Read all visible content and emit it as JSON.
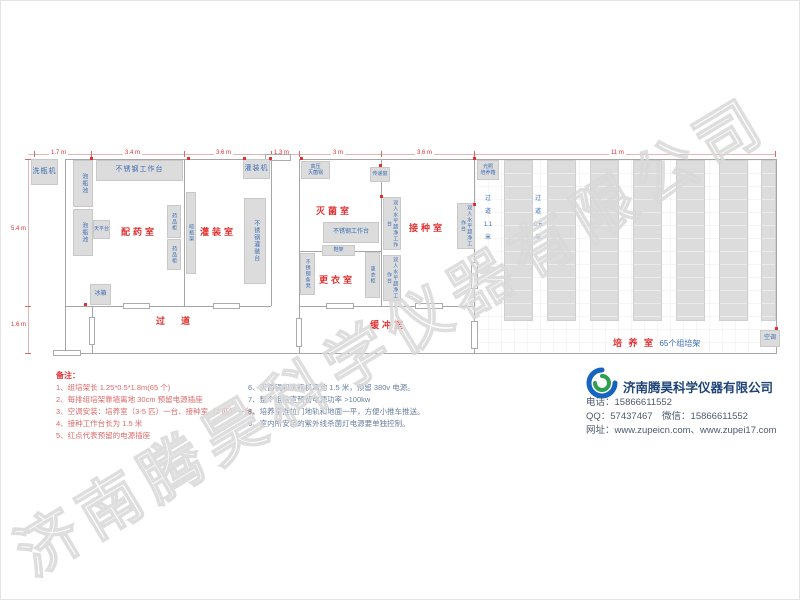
{
  "watermark": "济南腾昊科学仪器有限公司",
  "plan": {
    "dims_top": [
      "1.7 m",
      "3.4 m",
      "3.6 m",
      "1.3 m",
      "3 m",
      "3.6 m",
      "11 m"
    ],
    "dims_left": [
      "5.4 m",
      "1.6 m"
    ],
    "rooms": {
      "prep": "配药室",
      "filling": "灌装室",
      "sterilize": "灭菌室",
      "changing": "更衣室",
      "inoculation": "接种室",
      "corridor": "过道",
      "buffer": "缓冲室",
      "culture": "培 养 室",
      "culture_sub": "65个组培架",
      "aisle_wide": "过\n道\n1.1\n米",
      "aisle_narrow": "过\n道\n0.6\n米"
    },
    "equipment": {
      "washer": "洗瓶机",
      "soak_pool": "泡瓶池",
      "worktable": "不锈钢工作台",
      "balance": "天平台",
      "med_cabinet": "药品柜",
      "bottle_rack": "晾瓶架",
      "filling_machine": "灌装机",
      "filling_table": "不锈钢灌装台",
      "fridge": "冰箱",
      "autoclave": "高压\n灭菌锅",
      "pass_window": "传递窗",
      "shoe_rack": "鞋架",
      "steel_bench": "不锈钢条凳",
      "locker": "更衣柜",
      "clean_bench": "双人水平超净工作台",
      "light_incubator": "光照\n培养箱",
      "air_conditioner": "空调"
    }
  },
  "notes": {
    "title": "备注：",
    "col1": [
      "1、组培架长 1.25*0.5*1.8m(65 个)",
      "2、每排组培架靠墙离地 30cm 预留电源插座",
      "3、空调安装：培养室（3-5 匹）一台、接种室（2 匹）一台。",
      "4、接种工作台长为 1.5 米",
      "5、红点代表预留的电源插座"
    ],
    "col2": [
      "6、灭菌锅和洗瓶机离地 1.5 米，预留 380v 电源。",
      "7、整个组培室预留电源功率 >100kw",
      "8、培养室推拉门地轨和地面一平，方便小推车推送。",
      "9、室内所安装的紫外线杀菌灯电源要单独控制。"
    ]
  },
  "company": {
    "name": "济南腾昊科学仪器有限公司",
    "phone": "电话：15866611552",
    "qq": "QQ：57437467　微信：15866611552",
    "web": "网址：www.zupeicn.com、www.zupei17.com"
  },
  "colors": {
    "room_label": "#e03131",
    "equipment_label": "#3a6db5",
    "note_red": "#d96a6a",
    "note_blue": "#6a7f9f",
    "brand_navy": "#1f4477",
    "box_fill": "#dcdcdc"
  }
}
